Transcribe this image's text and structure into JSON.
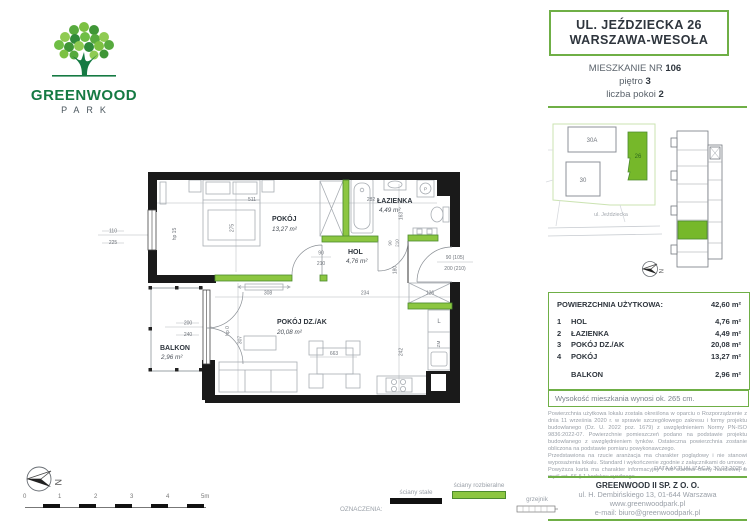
{
  "colors": {
    "accent_green": "#6FAF46",
    "wall_green_fill": "#8CC641",
    "wall_green_stroke": "#4C8A2E",
    "wall_black": "#1A1A1A",
    "dark_text": "#2E353D",
    "gray_text": "#9AA0A8"
  },
  "logo": {
    "name": "GREENWOOD",
    "sub": "PARK"
  },
  "header": {
    "address_line1": "UL. JEŹDZIECKA 26",
    "address_line2": "WARSZAWA-WESOŁA",
    "apartment_label": "MIESZKANIE NR ",
    "apartment_number": "106",
    "floor_label": "piętro ",
    "floor": "3",
    "rooms_label": "liczba pokoi ",
    "rooms": "2"
  },
  "site_plan": {
    "building_a": "30A",
    "building_b": "30",
    "building_main": "26",
    "street": "ul. Jeździecka",
    "north_letter": "N"
  },
  "floor_plan": {
    "rooms": {
      "pokoj": {
        "name": "POKÓJ",
        "area": "13,27 m²"
      },
      "lazienka": {
        "name": "ŁAZIENKA",
        "area": "4,49 m²"
      },
      "hol": {
        "name": "HOL",
        "area": "4,76 m²"
      },
      "pokoj_dz": {
        "name": "POKÓJ DZ./AK",
        "area": "20,08 m²"
      },
      "balkon": {
        "name": "BALKON",
        "area": "2,96 m²"
      }
    },
    "dims": {
      "d511": "511",
      "d275": "275",
      "d282": "282",
      "d163": "163",
      "d180": "180",
      "d308": "308",
      "d234": "234",
      "d126": "126",
      "d663": "663",
      "d242": "242",
      "d307": "307",
      "win_w": "110",
      "win_h": "225",
      "hp15": "hp 15",
      "hp0": "hp 0",
      "bal_w": "200",
      "bal_h": "240",
      "door_w": "90",
      "door_h": "210",
      "entry_w": "90 (105)",
      "entry_h": "200 (210)",
      "washer": "P",
      "fridge": "L",
      "dishwasher": "ZM"
    }
  },
  "area_table": {
    "title": "POWIERZCHNIA UŻYTKOWA:",
    "total": "42,60 m²",
    "rows": [
      {
        "no": "1",
        "name": "HOL",
        "area": "4,76 m²"
      },
      {
        "no": "2",
        "name": "ŁAZIENKA",
        "area": "4,49 m²"
      },
      {
        "no": "3",
        "name": "POKÓJ DZ./AK",
        "area": "20,08 m²"
      },
      {
        "no": "4",
        "name": "POKÓJ",
        "area": "13,27 m²"
      }
    ],
    "balcony": {
      "name": "BALKON",
      "area": "2,96 m²"
    }
  },
  "height_note": "Wysokość mieszkania wynosi ok. 265 cm.",
  "disclaimer": "Powierzchnia użytkowa lokalu została określona w oparciu o Rozporządzenie z dnia 11 września 2020 r. w sprawie szczegółowego zakresu i formy projektu budowlanego (Dz. U. 2022 poz. 1679) z uwzględnieniem Normy PN-ISO 9836:2022-07. Powierzchnie pomieszczeń podano na podstawie projektu budowlanego z uwzględnieniem tynków. Ostateczna powierzchnia zostanie obliczona na podstawie pomiaru powykonawczego.\nPrzedstawiona na rzucie aranżacja ma charakter poglądowy i nie stanowi wyposażenia lokalu. Standard i wykończenie zgodnie z załącznikami do umowy.\nPowyższa karta ma charakter informacyjny i nie stanowi oferty handlowej w myśl art. 66 § 1 kodeksu cywilnego.",
  "update_date": "DATA AKTUALIZACJI: 30.07.2025 r.",
  "footer": {
    "company": "GREENWOOD II SP. Z O. O.",
    "address": "ul. H. Dembińskiego 13, 01-644 Warszawa",
    "website": "www.greenwoodpark.pl",
    "email": "e-mail: biuro@greenwoodpark.pl"
  },
  "legend": {
    "label": "OZNACZENIA:",
    "solid_walls": "ściany stałe",
    "removable_walls": "ściany rozbieralne",
    "radiator": "grzejnik"
  },
  "scale_bar": {
    "ticks": [
      "0",
      "1",
      "2",
      "3",
      "4",
      "5m"
    ]
  }
}
